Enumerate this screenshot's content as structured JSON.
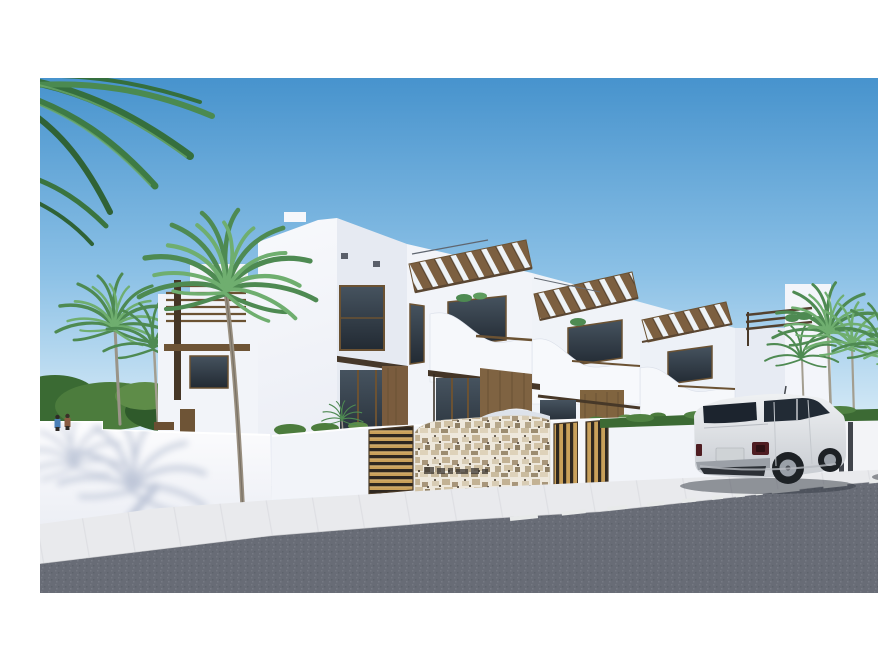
{
  "scene": {
    "description": "3D architectural rendering of a row of modern white two-storey townhouses with wooden pergolas, curved balconies and slatted wood gates; palm trees behind white boundary walls; a white SUV and a dark car parked on an asphalt street with a dashed centre line; white letterbox bands above and below the photo",
    "photo": {
      "top": 62,
      "bottom": 577,
      "left": 0,
      "right": 878
    },
    "objects": {
      "buildings": [
        "row of white townhouses with wooden roof pergolas and wavy balcony parapets",
        "small white annex building on the left with horizontal pergola slats",
        "tall white end building on the right with roof terrace plants"
      ],
      "street": [
        "asphalt road with white dashed centre line",
        "light concrete pavement",
        "white boundary wall with palm-frond shadow",
        "front fence with golden wood slat gates",
        "rough stone entrance wall with illegible dark engraved sign"
      ],
      "vehicles": [
        "white luxury SUV parked at the kerb, rear three-quarter view",
        "dark sedan partially visible at the right edge"
      ],
      "vegetation": [
        "palm fronds overhanging the top-left corner",
        "palm trees behind the left wall",
        "row of palm trees above the right hedge",
        "green hedge strip along the right wall",
        "small shrubs along the fence"
      ],
      "people": [
        "two small figures standing behind the left wall"
      ],
      "sign_text": "illegible"
    },
    "colors": {
      "frame_background": "#ffffff",
      "sky_top": "#4793cd",
      "sky_mid": "#8cc1e6",
      "sky_horizon": "#ddeef8",
      "building_white": "#f2f4f9",
      "building_shadow": "#e3e8f1",
      "wood_dark": "#5a4632",
      "wood_mid": "#7c5f40",
      "wood_slat_gold": "#c9a05a",
      "glass_dark": "#2c3845",
      "palm_green": "#4e8a52",
      "palm_green_light": "#6fae6f",
      "frond_dark_green": "#356f3d",
      "hedge_green": "#3c6a34",
      "stone_beige": "#eee8dc",
      "asphalt": "#686c76",
      "sidewalk": "#e9eaed",
      "lane_marking": "#e8eaea",
      "suv_body_light": "#eef0f2",
      "suv_body_dark": "#c6cad0",
      "dark_car_body": "#151b26",
      "shadow_blue": "#8b9ab8"
    }
  }
}
